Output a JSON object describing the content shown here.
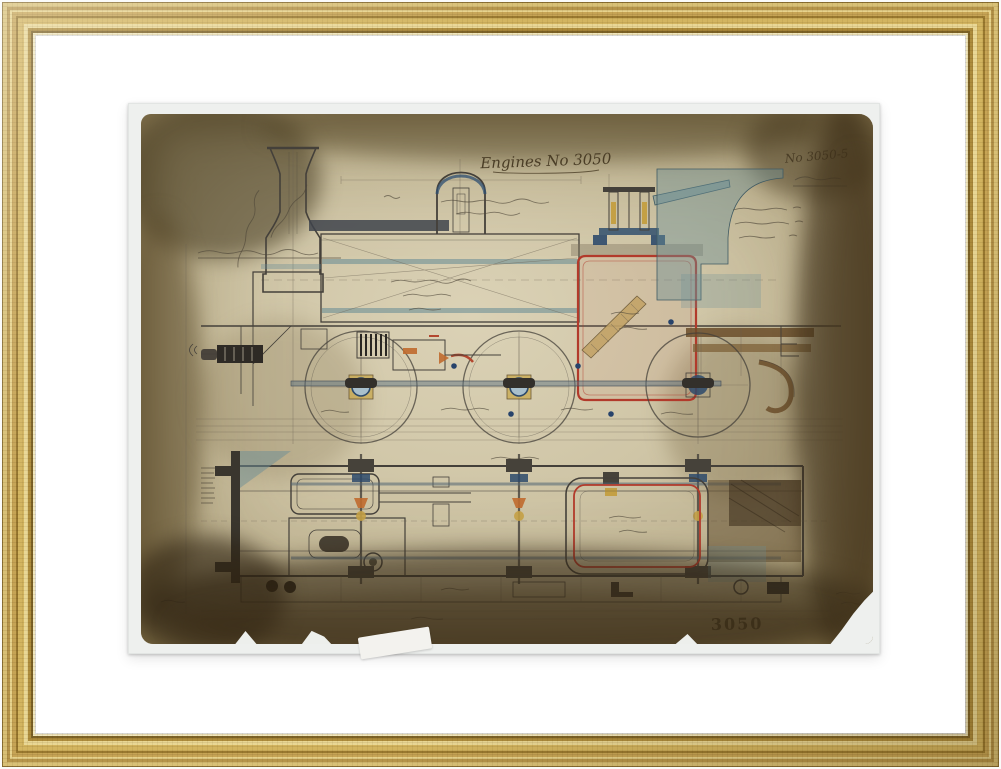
{
  "scene": {
    "description": "Photograph of a framed antique engineering drawing of a steam tank locomotive, shown in a gold frame with a white mat",
    "frame_material": "ornate gilded wood",
    "mat_color": "#ffffff",
    "print_margin_color": "#eef0ee"
  },
  "palette": {
    "frame_gold_light": "#e9d795",
    "frame_gold_mid": "#c6a455",
    "frame_gold_dark": "#7c6226",
    "paper_base": "#cfc5a6",
    "paper_stain_dark": "#4a3b22",
    "ink": "#44403a",
    "teal_wash": "#6f93a0",
    "blue_accent": "#2d4a6b",
    "red_outline": "#b23a2b",
    "orange_accent": "#c06a2d",
    "ochre_accent": "#c4a045",
    "brown_wash": "#6b4e2a"
  },
  "inscriptions": {
    "title": "Engines No 3050",
    "title_style": "handwritten cursive, underlined, top centre",
    "corner_number": "No 3050-5",
    "corner_number_style": "handwritten, top right, above an underlined signature",
    "stamp": "3050",
    "stamp_style": "dark stamped number near bottom right edge"
  },
  "drawing": {
    "subject": "Steam tank locomotive: longitudinal section / side elevation above, chassis plan view below",
    "views": [
      {
        "name": "side-elevation",
        "elements": [
          "chimney",
          "steam dome",
          "boiler with tube bands",
          "safety valve",
          "firebox outlined in red",
          "sloping grate",
          "cab spectacle plate (teal wash)",
          "three driving wheels",
          "coupling rod",
          "cylinder and motion",
          "front buffer",
          "rear footplate and pipe"
        ]
      },
      {
        "name": "chassis-plan",
        "elements": [
          "front buffer beam",
          "cylinders",
          "three axles with axleboxes",
          "coupling rods",
          "firebox in plan outlined in red",
          "coal bunker (dark brown wash)",
          "frame rails",
          "footplate strip"
        ]
      }
    ],
    "condition": "heavily age-stained paper, darkened edges, torn bottom-right corner and small tears along bottom edge"
  }
}
